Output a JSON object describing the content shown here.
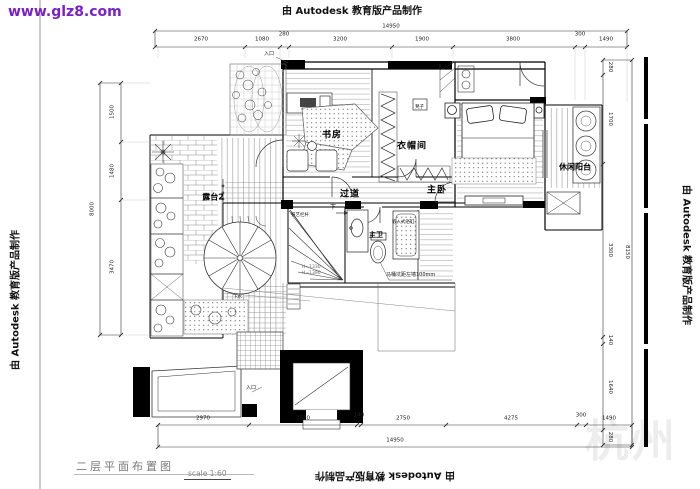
{
  "watermarks": {
    "site": "www.glz8.com",
    "autodesk": "由 Autodesk 教育版产品制作",
    "faint_corner": "杭州",
    "site_color": "#7b1fc8",
    "faint_color": "#ededed"
  },
  "title_block": {
    "title": "二层平面布置图",
    "scale": "scale 1:60"
  },
  "rooms": {
    "study": "书房",
    "cloakroom": "衣帽间",
    "corridor": "过道",
    "master_bedroom": "主卧",
    "leisure_balcony": "休闲阳台",
    "terrace2": "露台2",
    "master_bath": "主卫"
  },
  "annotations": {
    "bathtub": "嵌入式浴缸",
    "railing": "铁艺栏杆",
    "toilet_note": "马桶坑距左墙100mm",
    "stair_down": "下",
    "entrance_top": "入口",
    "entrance_bottom": "入口",
    "stool": "凳子",
    "drain": "下水",
    "height_note_1": "H=1330",
    "height_note_2": "H=1390"
  },
  "dimensions": {
    "top": {
      "total": "14950",
      "segments": [
        "2670",
        "1080",
        "280",
        "3200",
        "1900",
        "3800",
        "300",
        "1490"
      ]
    },
    "bottom": {
      "total": "14950",
      "segments": [
        "2970",
        "3510",
        "140",
        "2750",
        "4275",
        "300",
        "1490"
      ]
    },
    "right": {
      "total": "8150",
      "segments": [
        "280",
        "1700",
        "3300",
        "140",
        "1640",
        "280"
      ]
    },
    "left": {
      "total": "8000",
      "segments": [
        "1500",
        "1480",
        "3470"
      ]
    }
  }
}
